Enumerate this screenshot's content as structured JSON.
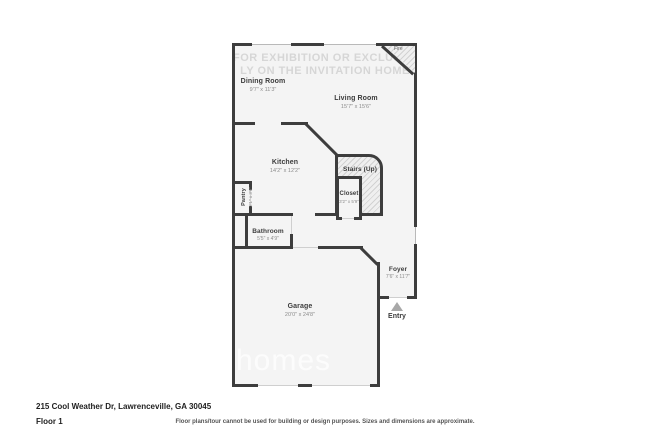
{
  "address_line": "215 Cool Weather Dr, Lawrenceville, GA 30045",
  "floor_label": "Floor 1",
  "disclaimer": "Floor plans/tour cannot be used for building or design purposes. Sizes and dimensions are approximate.",
  "watermark": {
    "line1": "FOR EXHIBITION OR EXCLUSIVE",
    "line2": "LY ON THE INVITATION HOME",
    "logo_text": "homes"
  },
  "rooms": [
    {
      "name": "Dining Room",
      "dims": "9'7\" x 11'3\""
    },
    {
      "name": "Living Room",
      "dims": "15'7\" x 15'6\""
    },
    {
      "name": "Kitchen",
      "dims": "14'2\" x 12'2\""
    },
    {
      "name": "Stairs (Up)",
      "dims": ""
    },
    {
      "name": "Closet",
      "dims": "3'2\" x 5'9\""
    },
    {
      "name": "Pantry",
      "dims": "2'1\" x 3'6\""
    },
    {
      "name": "Bathroom",
      "dims": "5'5\" x 4'9\""
    },
    {
      "name": "Foyer",
      "dims": "7'6\" x 11'7\""
    },
    {
      "name": "Garage",
      "dims": "20'0\" x 24'8\""
    }
  ],
  "markers": {
    "entry_label": "Entry",
    "fireplace_label": "Fire"
  },
  "colors": {
    "wall": "#3d3d3d",
    "floor_fill": "#f4f4f4",
    "page_background": "#ffffff",
    "dims_text": "#8c8c8c",
    "entry_marker": "#a8a8a8"
  }
}
